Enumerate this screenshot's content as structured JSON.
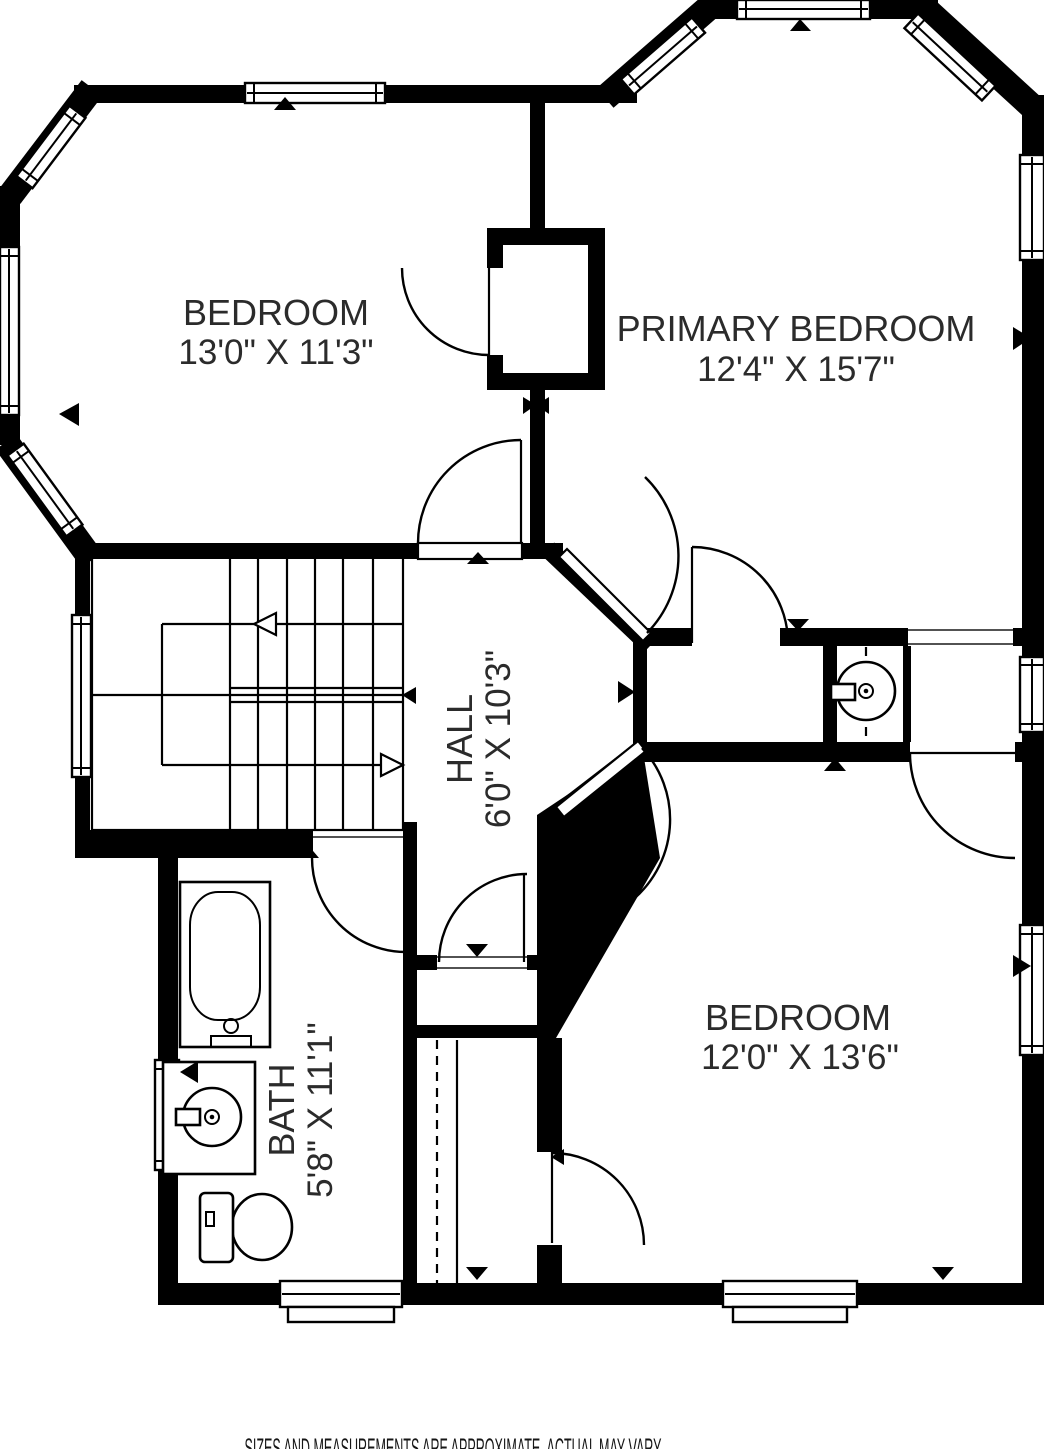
{
  "rooms": [
    {
      "name": "BEDROOM",
      "dims": "13'0\" X 11'3\""
    },
    {
      "name": "PRIMARY BEDROOM",
      "dims": "12'4\" X 15'7\""
    },
    {
      "name": "HALL",
      "dims": "6'0\" X 10'3\""
    },
    {
      "name": "BATH",
      "dims": "5'8\" X 11'1\""
    },
    {
      "name": "BEDROOM",
      "dims": "12'0\" X 13'6\""
    }
  ],
  "disclaimer": "SIZES AND MEASUREMENTS ARE APPROXIMATE, ACTUAL MAY VARY",
  "colors": {
    "wall": "#000000",
    "background": "#ffffff",
    "text": "#2b2b2b"
  }
}
